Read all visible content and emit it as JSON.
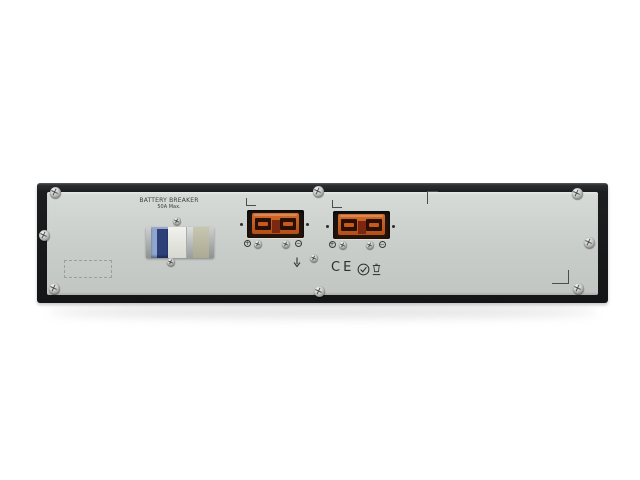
{
  "device": {
    "breaker": {
      "label_line1": "BATTERY BREAKER",
      "label_line2": "50A Max."
    },
    "connector_symbols": {
      "plus": "+",
      "minus": "−"
    },
    "certifications": {
      "ce_label": "CE"
    },
    "colors": {
      "frame": "#1b1d1f",
      "panel": "#c9cdca",
      "connector_orange": "#c2581f",
      "connector_recess": "#241209",
      "breaker_blue": "#2e4079",
      "breaker_stripe": "#8fa6cf",
      "breaker_beige": "#b8b6a0",
      "background": "#ffffff"
    }
  }
}
